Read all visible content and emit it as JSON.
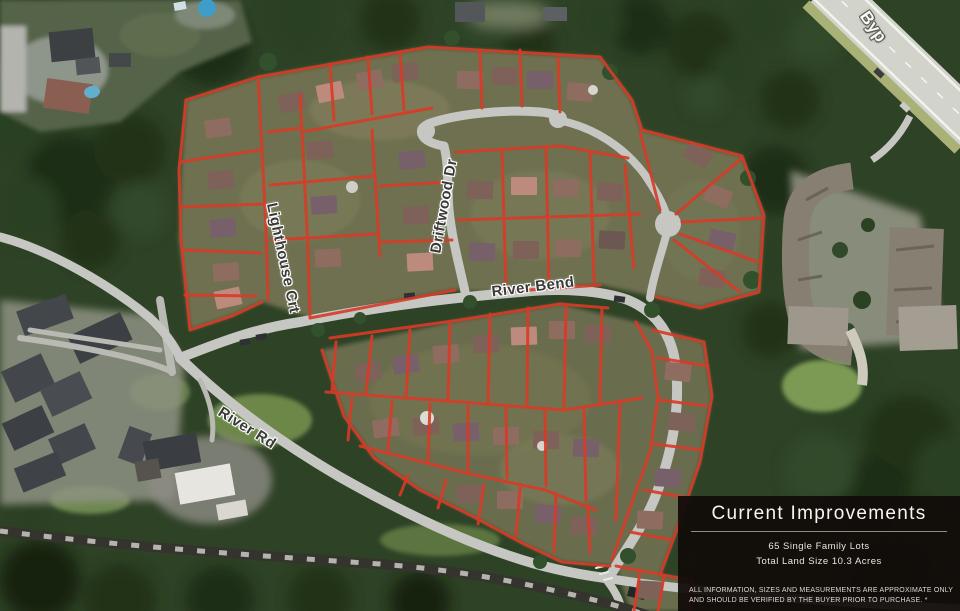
{
  "map": {
    "street_labels": {
      "lighthouse": "Lighthouse Crt",
      "driftwood": "Driftwood Dr",
      "river_bend": "River Bend",
      "river_rd": "River Rd",
      "bypass": "Byp"
    },
    "lot_outline_color": "#d83b27"
  },
  "panel": {
    "title": "Current Improvements",
    "stat_lots": "65 Single Family Lots",
    "stat_land": "Total Land Size 10.3 Acres",
    "disclaimer": "ALL INFORMATION, SIZES AND MEASUREMENTS ARE APPROXIMATE ONLY AND SHOULD BE VERIFIED BY THE BUYER PRIOR TO PURCHASE. *"
  }
}
